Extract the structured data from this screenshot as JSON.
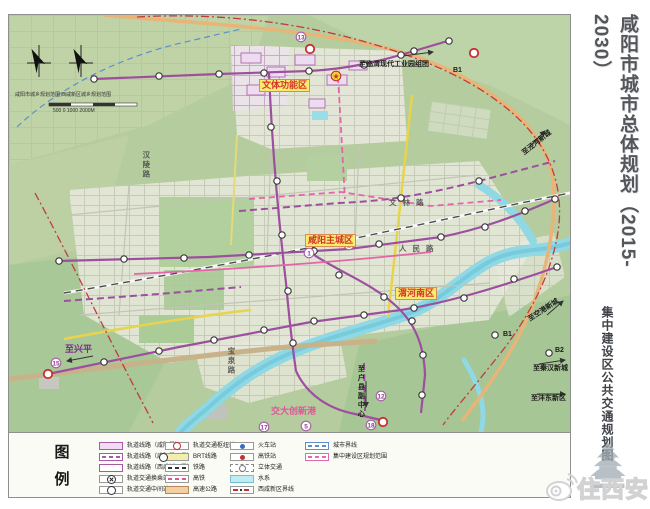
{
  "title_panel": {
    "title": "咸阳市城市总体规划（2015-2030）",
    "subtitle": "集中建设区公共交通规划图"
  },
  "page": {
    "watermark_text": "住西安"
  },
  "legend": {
    "heading_chars": [
      "图",
      "例"
    ],
    "col1": [
      "轨道线路（咸阳段）",
      "轨道线路（咸阳段远景）",
      "轨道线路（西咸新区段）",
      "轨道交通换乘站",
      "轨道交通中间站"
    ],
    "col2": [
      "轨道交通枢纽站",
      "BRT线路",
      "铁路",
      "高铁",
      "高速公路"
    ],
    "col3": [
      "火车站",
      "高铁站",
      "立体交通",
      "水系",
      "西咸新区界线"
    ],
    "col4": [
      "城市界线",
      "集中建设区规划范围"
    ]
  },
  "map": {
    "labels": [
      {
        "text": "文体功能区",
        "x": 250,
        "y": 64,
        "cls": "zone"
      },
      {
        "text": "咸阳主城区",
        "x": 296,
        "y": 219,
        "cls": "zone"
      },
      {
        "text": "渭河南区",
        "x": 386,
        "y": 272,
        "cls": "zone"
      },
      {
        "text": "交大创新港",
        "x": 262,
        "y": 392,
        "cls": "pink"
      },
      {
        "text": "至兴平",
        "x": 56,
        "y": 330,
        "cls": "dest"
      },
      {
        "text": "至临渭现代工业园组团",
        "x": 350,
        "y": 46,
        "cls": "small"
      },
      {
        "text": "至泾河新城",
        "x": 512,
        "y": 136,
        "cls": "small",
        "rot": -38
      },
      {
        "text": "至空港新城",
        "x": 518,
        "y": 302,
        "cls": "small",
        "rot": -33
      },
      {
        "text": "至秦汉新城",
        "x": 524,
        "y": 350,
        "cls": "small"
      },
      {
        "text": "至沣东新区",
        "x": 522,
        "y": 380,
        "cls": "small"
      },
      {
        "text": "至户县副中心",
        "x": 348,
        "y": 350,
        "cls": "small",
        "vert": true
      },
      {
        "text": "B1",
        "x": 444,
        "y": 52,
        "cls": "small"
      },
      {
        "text": "B1",
        "x": 494,
        "y": 316,
        "cls": "small"
      },
      {
        "text": "B2",
        "x": 546,
        "y": 332,
        "cls": "small"
      },
      {
        "text": "文林路",
        "x": 380,
        "y": 184,
        "cls": "road"
      },
      {
        "text": "人民路",
        "x": 390,
        "y": 230,
        "cls": "road"
      },
      {
        "text": "汉陵路",
        "x": 133,
        "y": 136,
        "cls": "road",
        "vert": true
      },
      {
        "text": "宝泉路",
        "x": 218,
        "y": 332,
        "cls": "road",
        "vert": true
      },
      {
        "text": "咸阳市城乡规划范围",
        "x": 6,
        "y": 78,
        "cls": "cap"
      },
      {
        "text": "西咸新区城乡规划范围",
        "x": 52,
        "y": 78,
        "cls": "cap"
      },
      {
        "text": "500 0 1000 2000M",
        "x": 44,
        "y": 94,
        "cls": "cap"
      }
    ],
    "stations": [
      [
        85,
        64
      ],
      [
        150,
        61
      ],
      [
        210,
        59
      ],
      [
        255,
        58
      ],
      [
        300,
        56
      ],
      [
        355,
        50
      ],
      [
        405,
        36
      ],
      [
        440,
        26
      ],
      [
        392,
        40
      ],
      [
        262,
        112
      ],
      [
        268,
        166
      ],
      [
        273,
        220
      ],
      [
        279,
        276
      ],
      [
        284,
        328
      ],
      [
        50,
        246
      ],
      [
        115,
        244
      ],
      [
        175,
        243
      ],
      [
        240,
        240
      ],
      [
        305,
        236
      ],
      [
        370,
        229
      ],
      [
        432,
        222
      ],
      [
        476,
        212
      ],
      [
        516,
        196
      ],
      [
        546,
        184
      ],
      [
        95,
        347
      ],
      [
        150,
        336
      ],
      [
        205,
        325
      ],
      [
        255,
        315
      ],
      [
        305,
        306
      ],
      [
        355,
        300
      ],
      [
        405,
        293
      ],
      [
        455,
        283
      ],
      [
        505,
        264
      ],
      [
        548,
        252
      ],
      [
        330,
        260
      ],
      [
        375,
        282
      ],
      [
        403,
        306
      ],
      [
        414,
        340
      ],
      [
        413,
        380
      ],
      [
        392,
        183
      ],
      [
        470,
        166
      ],
      [
        486,
        320
      ],
      [
        540,
        338
      ]
    ],
    "hub_stations": [
      [
        301,
        34
      ],
      [
        465,
        38
      ],
      [
        374,
        407
      ],
      [
        39,
        359
      ]
    ],
    "numbered_stops": [
      {
        "n": "13",
        "x": 292,
        "y": 22
      },
      {
        "n": "★",
        "x": 327,
        "y": 61,
        "style": "yellow"
      },
      {
        "n": "1",
        "x": 300,
        "y": 238
      },
      {
        "n": "2",
        "x": 340,
        "y": 230
      },
      {
        "n": "15",
        "x": 47,
        "y": 348
      },
      {
        "n": "12",
        "x": 372,
        "y": 381
      },
      {
        "n": "18",
        "x": 362,
        "y": 410
      },
      {
        "n": "5",
        "x": 297,
        "y": 411
      },
      {
        "n": "17",
        "x": 255,
        "y": 412
      }
    ]
  },
  "colors": {
    "rail_purple": "#9c4f9e",
    "brt_pink": "#e266a8",
    "highway_orange": "#e8b478",
    "water_cyan": "#8fd8e4",
    "boundary_red": "#c23b3b",
    "boundary_blue": "#5b8fd0",
    "zone_label_bg": "#f8ec6e",
    "zone_label_text": "#d3342c",
    "map_green": "#b4cc9e"
  }
}
